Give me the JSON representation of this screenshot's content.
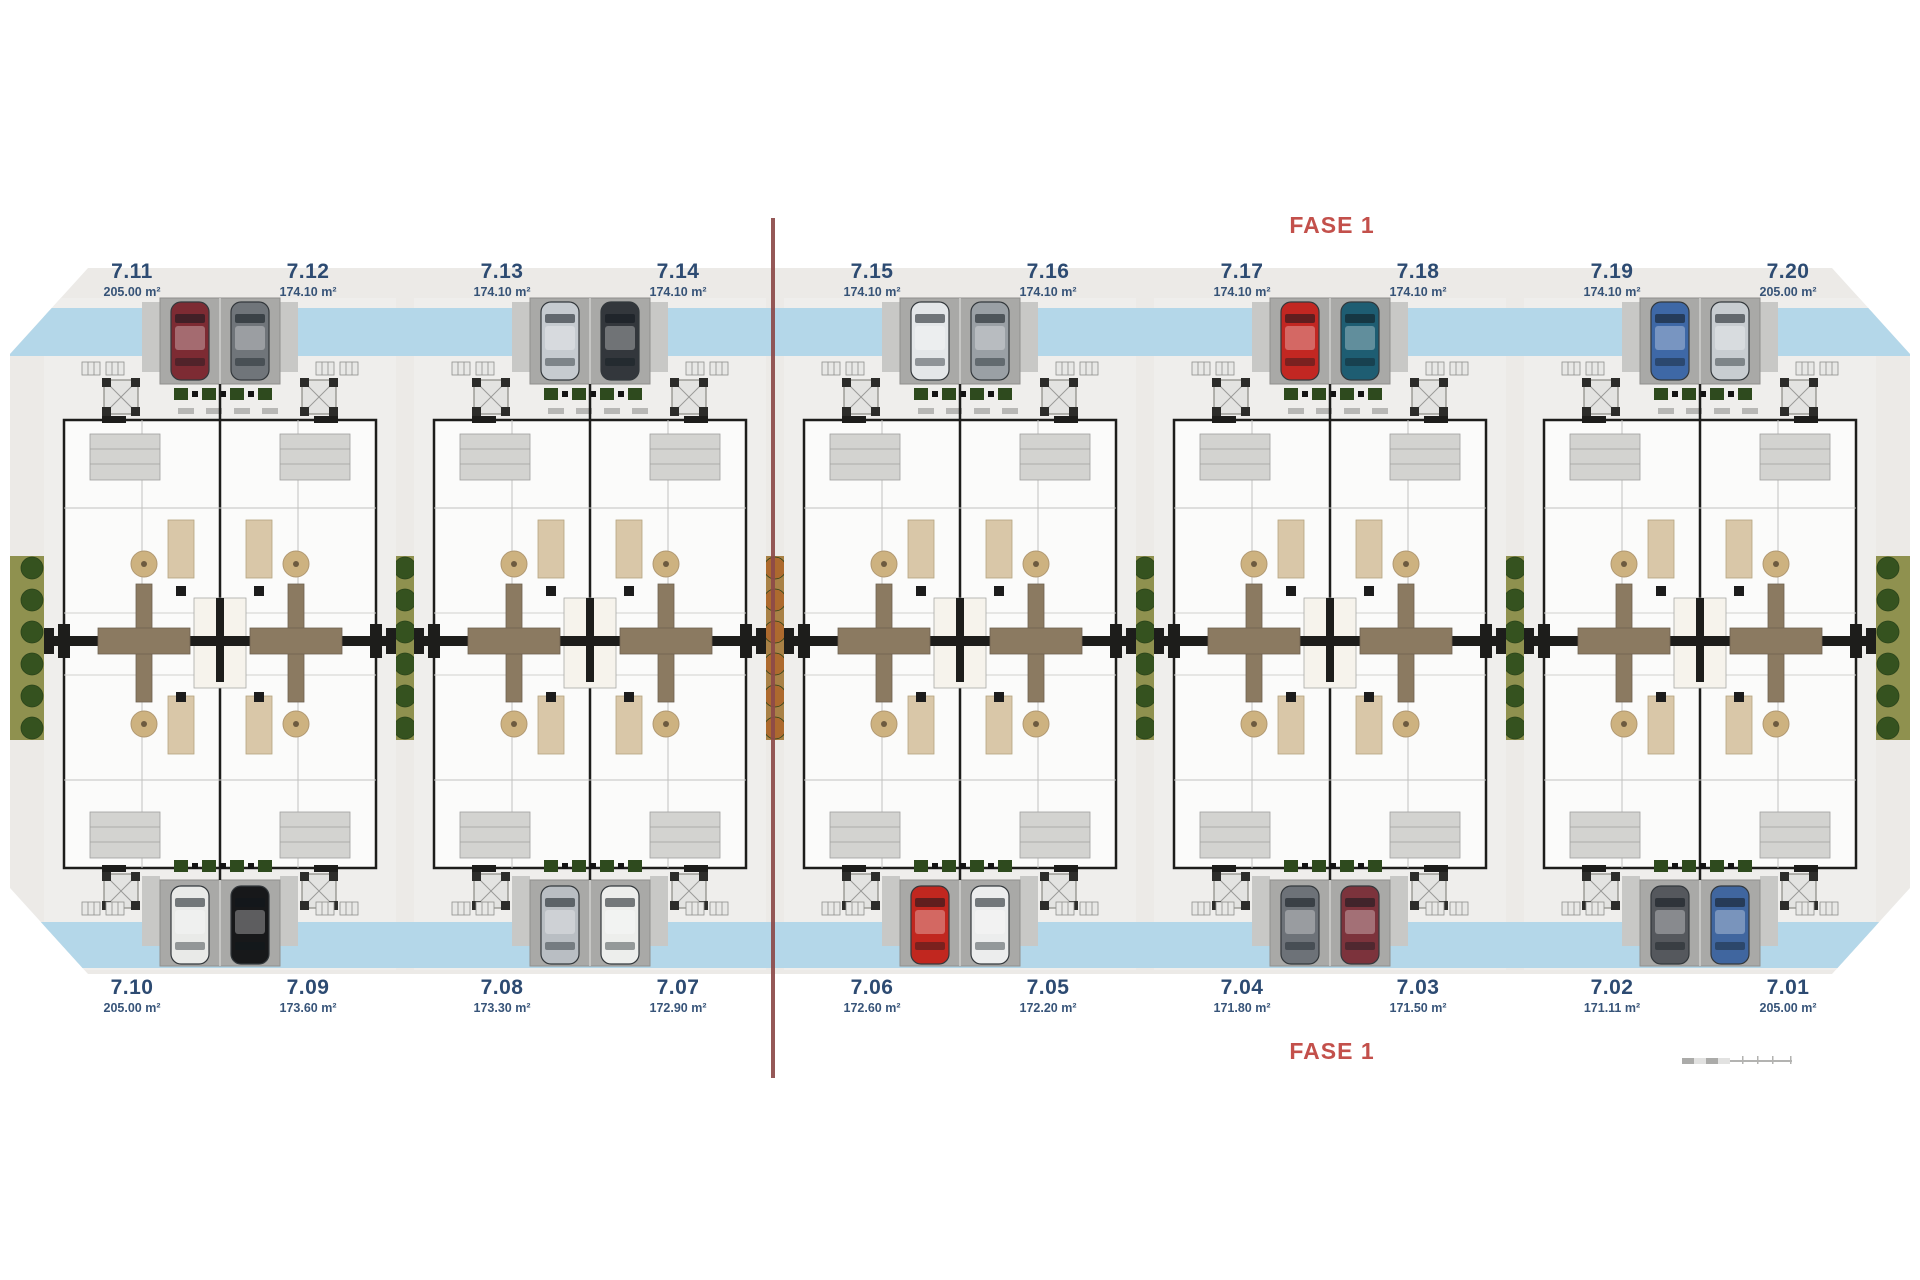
{
  "phase": {
    "top_label": "FASE 1",
    "bottom_label": "FASE 1"
  },
  "units_top": [
    {
      "id": "7.11",
      "area": "205.00 m²"
    },
    {
      "id": "7.12",
      "area": "174.10 m²"
    },
    {
      "id": "7.13",
      "area": "174.10 m²"
    },
    {
      "id": "7.14",
      "area": "174.10 m²"
    },
    {
      "id": "7.15",
      "area": "174.10 m²"
    },
    {
      "id": "7.16",
      "area": "174.10 m²"
    },
    {
      "id": "7.17",
      "area": "174.10 m²"
    },
    {
      "id": "7.18",
      "area": "174.10 m²"
    },
    {
      "id": "7.19",
      "area": "174.10 m²"
    },
    {
      "id": "7.20",
      "area": "205.00 m²"
    }
  ],
  "units_bottom": [
    {
      "id": "7.10",
      "area": "205.00 m²"
    },
    {
      "id": "7.09",
      "area": "173.60 m²"
    },
    {
      "id": "7.08",
      "area": "173.30 m²"
    },
    {
      "id": "7.07",
      "area": "172.90 m²"
    },
    {
      "id": "7.06",
      "area": "172.60 m²"
    },
    {
      "id": "7.05",
      "area": "172.20 m²"
    },
    {
      "id": "7.04",
      "area": "171.80 m²"
    },
    {
      "id": "7.03",
      "area": "171.50 m²"
    },
    {
      "id": "7.02",
      "area": "171.11 m²"
    },
    {
      "id": "7.01",
      "area": "205.00 m²"
    }
  ],
  "blocks": [
    {
      "top_cars": [
        "#7d2b33",
        "#70757a"
      ],
      "bottom_cars": [
        "#e9eae8",
        "#17181a"
      ]
    },
    {
      "top_cars": [
        "#c6cbd0",
        "#33373c"
      ],
      "bottom_cars": [
        "#b9bec3",
        "#edeeec"
      ]
    },
    {
      "top_cars": [
        "#e4e7e9",
        "#9aa0a5"
      ],
      "bottom_cars": [
        "#c1271f",
        "#eceded"
      ]
    },
    {
      "top_cars": [
        "#c22722",
        "#1e5d72"
      ],
      "bottom_cars": [
        "#6d7278",
        "#7c333c"
      ]
    },
    {
      "top_cars": [
        "#3e68a6",
        "#c8cdd1"
      ],
      "bottom_cars": [
        "#55585d",
        "#40669f"
      ]
    }
  ],
  "gaps": [
    "olive",
    "orange",
    "olive",
    "olive"
  ],
  "colors": {
    "label": "#2d4b72",
    "fase": "#c3504b",
    "divider": "#8c4a49",
    "plan_bg": "#eceae7",
    "plot": "#efeeec",
    "band": "#b4d7e9",
    "pad": "#a9a9a7",
    "wall": "#1d1d1b",
    "olive": "#8f914f",
    "bush": "#35521f",
    "orange_base": "#a98146",
    "orange_bush": "#ad6a2e",
    "cross": "#8b7a61",
    "tan": "#cdb280",
    "scale": "#9a9a98"
  }
}
